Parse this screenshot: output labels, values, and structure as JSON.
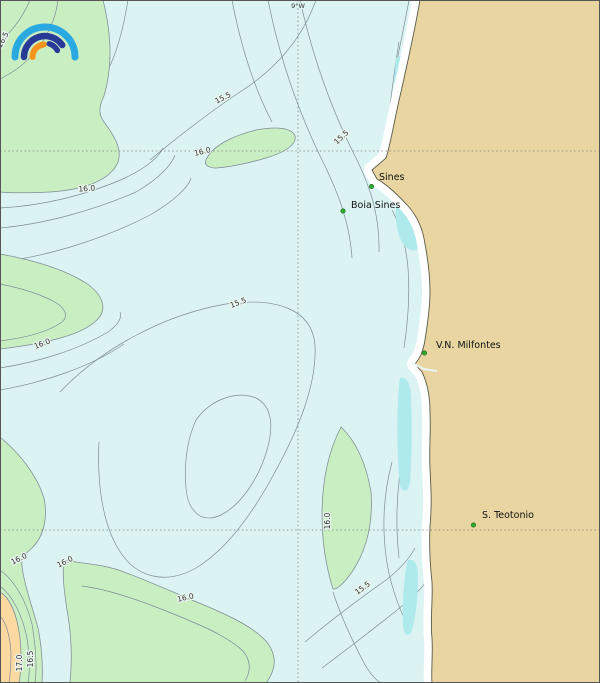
{
  "map": {
    "meridian_label": "9°W",
    "places": [
      {
        "name": "Sines"
      },
      {
        "name": "Boia Sines"
      },
      {
        "name": "V.N. Milfontes"
      },
      {
        "name": "S. Teotonio"
      }
    ],
    "contour_labels": [
      {
        "text": "16.5"
      },
      {
        "text": "15.5"
      },
      {
        "text": "15.5"
      },
      {
        "text": "16.0"
      },
      {
        "text": "16.0"
      },
      {
        "text": "15.5"
      },
      {
        "text": "16.0"
      },
      {
        "text": "16.0"
      },
      {
        "text": "15.5"
      },
      {
        "text": "16.0"
      },
      {
        "text": "16.0"
      },
      {
        "text": "16.0"
      },
      {
        "text": "17.0"
      },
      {
        "text": "16.5"
      }
    ],
    "colors": {
      "sea": "#dcf3f3",
      "band_16_165": "#c9eec2",
      "band_cold_coastal": "#aeeaec",
      "band_warm": "#fbd9a1",
      "land": "#e8d5a1",
      "contour_line": "#7f8c96",
      "coastline": "#5a5a49",
      "place_marker": "#2fae2f",
      "logo_lightblue": "#2aa9e0",
      "logo_darkblue": "#283a97",
      "logo_orange": "#f7941d"
    }
  }
}
